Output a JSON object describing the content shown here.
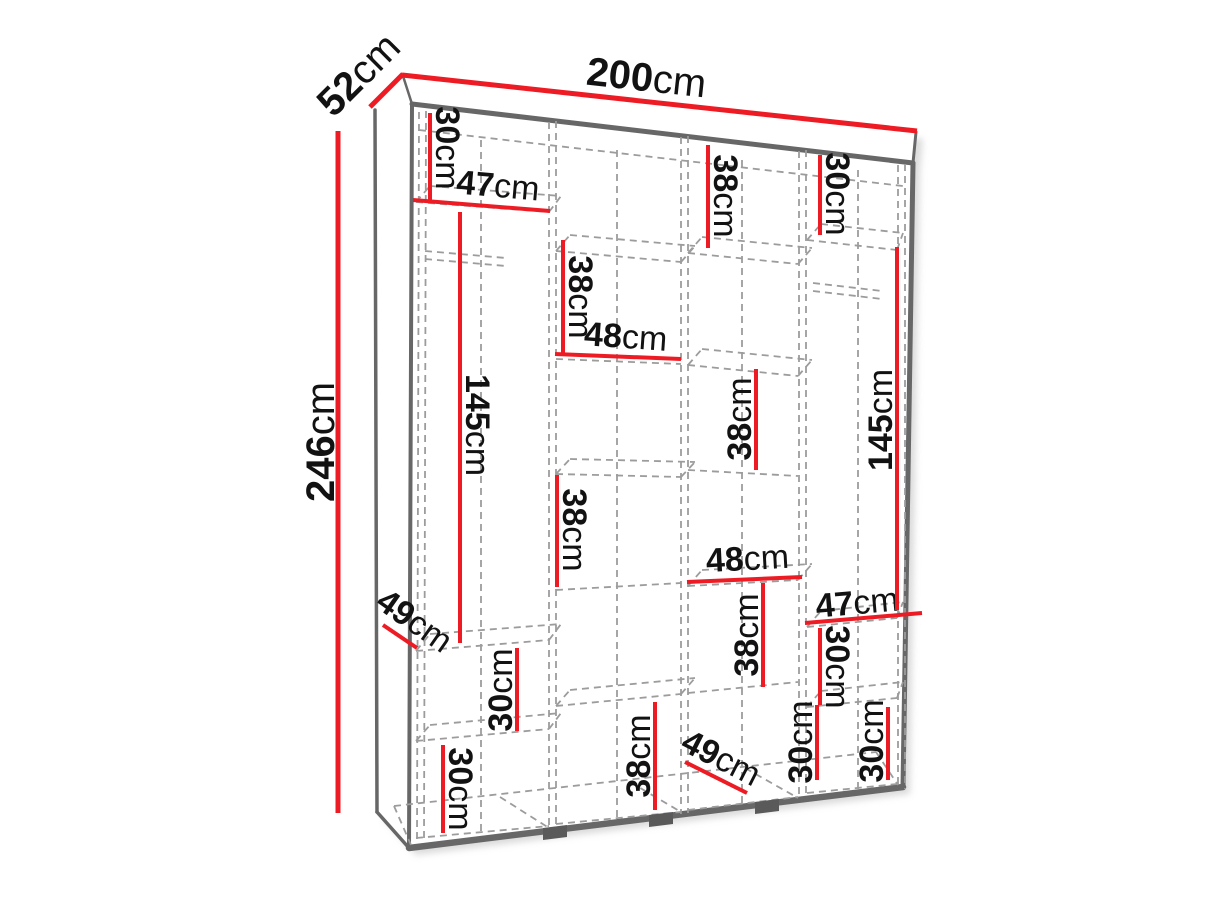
{
  "diagram_title": "wardrobe-dimension-diagram",
  "colors": {
    "dimension_red": "#ed1c24",
    "outline_gray": "#676767",
    "dash_gray": "#9c9c9c",
    "label_black": "#121212",
    "background": "#ffffff"
  },
  "overall": {
    "width": "200cm",
    "depth": "52cm",
    "height": "246cm"
  },
  "dims": {
    "depth_52": {
      "value": "52",
      "unit": "cm",
      "major": true,
      "line": [
        370,
        107,
        403,
        74
      ],
      "label": {
        "x": 368,
        "y": 84,
        "rotate": -45
      }
    },
    "width_200": {
      "value": "200",
      "unit": "cm",
      "major": true,
      "line": [
        402,
        75,
        917,
        131
      ],
      "label": {
        "x": 645,
        "y": 91,
        "rotate": 6.2
      }
    },
    "height_246": {
      "value": "246",
      "unit": "cm",
      "major": true,
      "line": [
        338,
        131,
        338,
        813
      ],
      "label": {
        "x": 334,
        "y": 442,
        "rotate": -90
      }
    },
    "top30_col1": {
      "value": "30",
      "unit": "cm",
      "line": [
        430,
        113,
        430,
        200
      ],
      "label": {
        "x": 436,
        "y": 148,
        "rotate": 90
      }
    },
    "top47_col1": {
      "value": "47",
      "unit": "cm",
      "line": [
        413,
        200,
        550,
        211
      ],
      "label": {
        "x": 497,
        "y": 197,
        "rotate": 5
      }
    },
    "top38_col2": {
      "value": "38",
      "unit": "cm",
      "line": [
        563,
        240,
        563,
        353
      ],
      "label": {
        "x": 569,
        "y": 297,
        "rotate": 90
      }
    },
    "top48_col2": {
      "value": "48",
      "unit": "cm",
      "line": [
        555,
        354,
        681,
        359
      ],
      "label": {
        "x": 625,
        "y": 348,
        "rotate": 4
      }
    },
    "top38_col3": {
      "value": "38",
      "unit": "cm",
      "line": [
        708,
        145,
        708,
        248
      ],
      "label": {
        "x": 714,
        "y": 196,
        "rotate": 90
      }
    },
    "top30_col4": {
      "value": "30",
      "unit": "cm",
      "line": [
        820,
        155,
        820,
        235
      ],
      "label": {
        "x": 826,
        "y": 194,
        "rotate": 90
      }
    },
    "mid145_col1": {
      "value": "145",
      "unit": "cm",
      "line": [
        460,
        212,
        460,
        643
      ],
      "label": {
        "x": 466,
        "y": 425,
        "rotate": 90
      }
    },
    "mid38_col2": {
      "value": "38",
      "unit": "cm",
      "line": [
        557,
        475,
        557,
        587
      ],
      "label": {
        "x": 563,
        "y": 530,
        "rotate": 90
      }
    },
    "mid38_col3_up": {
      "value": "38",
      "unit": "cm",
      "line": [
        756,
        369,
        756,
        470
      ],
      "label": {
        "x": 751,
        "y": 419,
        "rotate": -90
      }
    },
    "mid48_col3": {
      "value": "48",
      "unit": "cm",
      "line": [
        687,
        582,
        802,
        577
      ],
      "label": {
        "x": 748,
        "y": 570,
        "rotate": -3
      }
    },
    "mid47_col4": {
      "value": "47",
      "unit": "cm",
      "line": [
        805,
        623,
        922,
        613
      ],
      "label": {
        "x": 858,
        "y": 614,
        "rotate": -5
      }
    },
    "mid145_col4": {
      "value": "145",
      "unit": "cm",
      "line": [
        897,
        247,
        897,
        610
      ],
      "label": {
        "x": 892,
        "y": 420,
        "rotate": -90
      }
    },
    "mid49_col1": {
      "value": "49",
      "unit": "cm",
      "line": [
        383,
        625,
        417,
        648
      ],
      "label": {
        "x": 408,
        "y": 630,
        "rotate": 35
      }
    },
    "mid30_col1": {
      "value": "30",
      "unit": "cm",
      "line": [
        517,
        648,
        517,
        731
      ],
      "label": {
        "x": 512,
        "y": 690,
        "rotate": -90
      }
    },
    "bot30_col1": {
      "value": "30",
      "unit": "cm",
      "line": [
        443,
        745,
        443,
        833
      ],
      "label": {
        "x": 449,
        "y": 789,
        "rotate": 90
      }
    },
    "bot38_col2": {
      "value": "38",
      "unit": "cm",
      "line": [
        655,
        702,
        655,
        810
      ],
      "label": {
        "x": 650,
        "y": 756,
        "rotate": -90
      }
    },
    "mid38_col3_low": {
      "value": "38",
      "unit": "cm",
      "line": [
        763,
        583,
        763,
        687
      ],
      "label": {
        "x": 758,
        "y": 635,
        "rotate": -90
      }
    },
    "mid30_col4": {
      "value": "30",
      "unit": "cm",
      "line": [
        820,
        628,
        820,
        705
      ],
      "label": {
        "x": 826,
        "y": 667,
        "rotate": 90
      }
    },
    "bot49_col3": {
      "value": "49",
      "unit": "cm",
      "line": [
        685,
        762,
        747,
        793
      ],
      "label": {
        "x": 716,
        "y": 768,
        "rotate": 27
      }
    },
    "bot30_col4": {
      "value": "30",
      "unit": "cm",
      "line": [
        817,
        705,
        817,
        780
      ],
      "label": {
        "x": 812,
        "y": 742,
        "rotate": -90
      }
    },
    "bot30_right": {
      "value": "30",
      "unit": "cm",
      "line": [
        888,
        707,
        888,
        780
      ],
      "label": {
        "x": 883,
        "y": 741,
        "rotate": -90
      }
    }
  }
}
